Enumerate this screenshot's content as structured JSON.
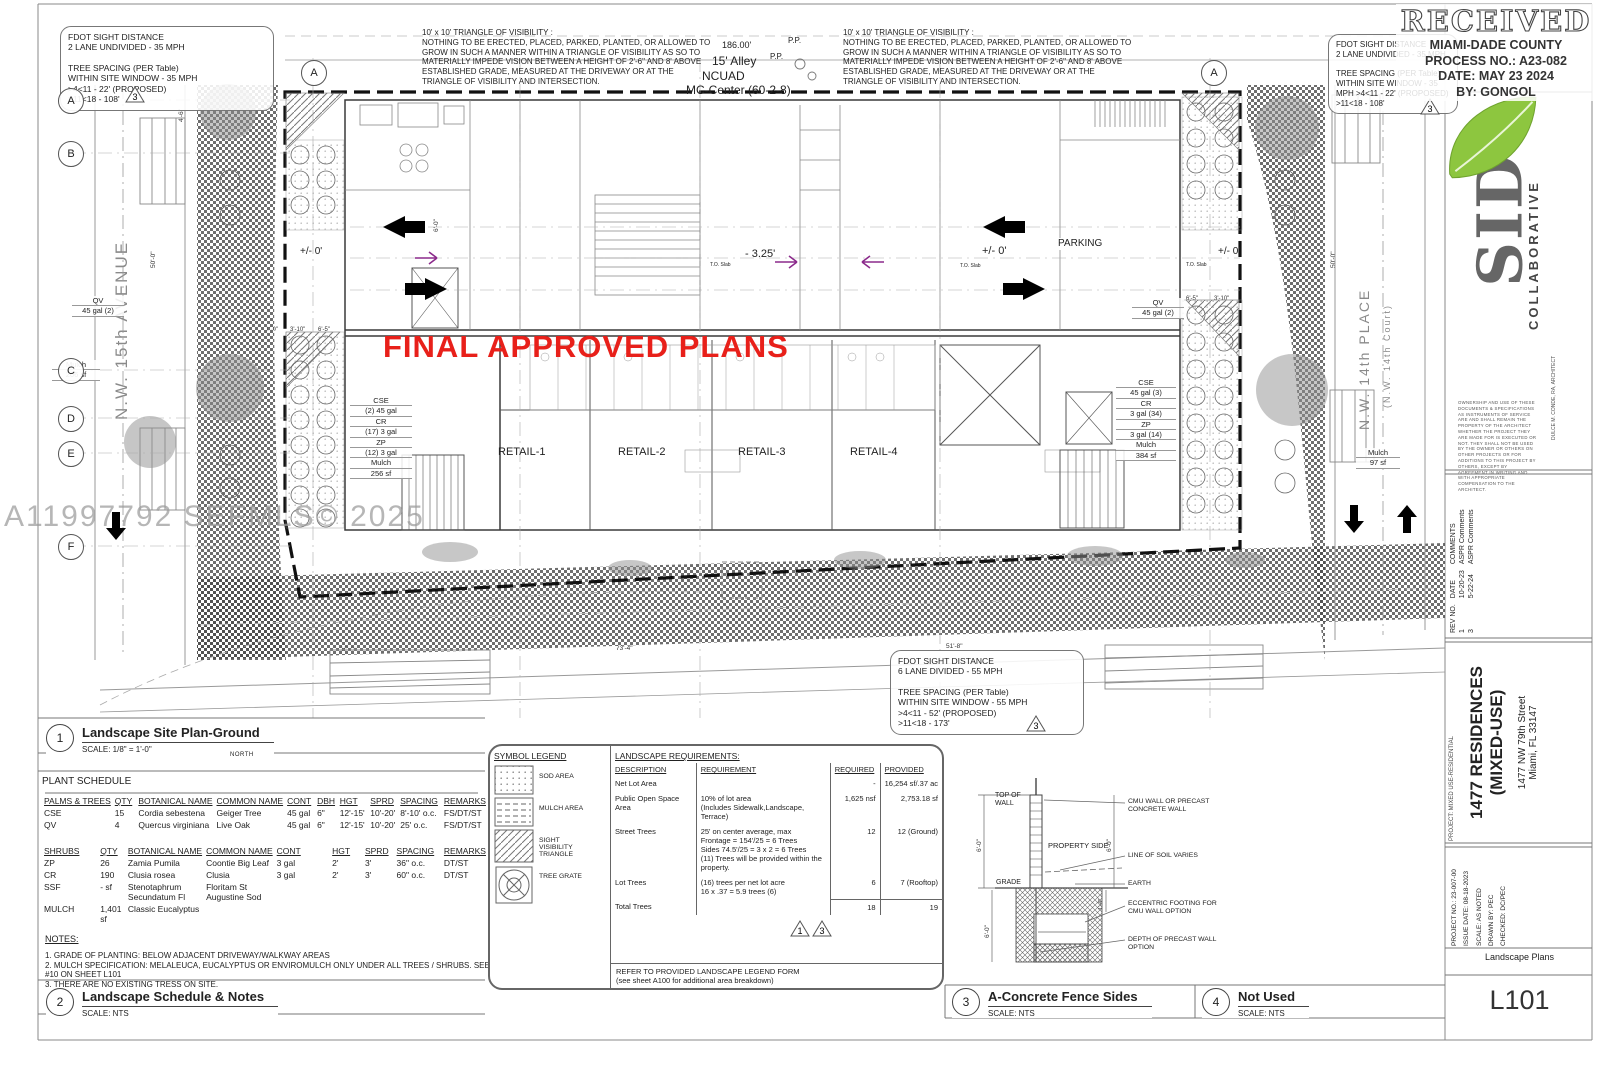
{
  "stamp": {
    "received": "RECEIVED",
    "agency": "MIAMI-DADE COUNTY",
    "process": "PROCESS NO.: A23-082",
    "date": "DATE: MAY 23 2024",
    "by": "BY: GONGOL"
  },
  "plan": {
    "watermark": "A11997792 SEFMLS© 2025",
    "final_approved": "FINAL APPROVED PLANS",
    "visibility_title": "10' x 10' TRIANGLE OF VISIBILITY :",
    "visibility_lines": [
      "NOTHING TO BE ERECTED, PLACED, PARKED, PLANTED, OR ALLOWED TO",
      "GROW IN SUCH A MANNER WITHIN A TRIANGLE OF VISIBILITY AS SO TO",
      "MATERIALLY IMPEDE VISION BETWEEN  A HEIGHT OF 2'-6\" AND 8' ABOVE",
      "ESTABLISHED GRADE, MEASURED AT THE DRIVEWAY OR AT THE",
      "TRIANGLE OF VISIBILITY AND INTERSECTION."
    ],
    "fdot_nw_lines": [
      "FDOT SIGHT DISTANCE",
      "2 LANE UNDIVIDED - 35 MPH",
      "",
      "TREE SPACING (PER Table)",
      "WITHIN SITE WINDOW - 35 MPH",
      ">4<11 - 22' (PROPOSED)",
      ">11<18 - 108'"
    ],
    "fdot_ne_lines": [
      "FDOT SIGHT DISTANCE",
      "2 LANE UNDIVIDED - 35 MPH",
      "",
      "TREE SPACING (PER Table)",
      "WITHIN SITE WINDOW - 35",
      "MPH >4<11 - 22' (PROPOSED)",
      ">11<18 - 108'"
    ],
    "fdot_s_lines": [
      "FDOT SIGHT DISTANCE",
      "6 LANE DIVIDED - 55 MPH",
      "",
      "TREE SPACING (PER Table)",
      "WITHIN SITE WINDOW - 55 MPH",
      ">4<11 - 52' (PROPOSED)",
      ">11<18 - 173'"
    ],
    "alley": {
      "dim": "186.00'",
      "name": "15' Alley",
      "zone1": "NCUAD",
      "zone2": "MC-Center (60-2-8)",
      "pp": "P.P.",
      "pp2": "P.P."
    },
    "streets": {
      "left": "N.W. 15th AVENUE",
      "right": "N.W. 14th PLACE",
      "right_sub": "(N.W. 14th Court)"
    },
    "retail": [
      "RETAIL-1",
      "RETAIL-2",
      "RETAIL-3",
      "RETAIL-4"
    ],
    "parking": "PARKING",
    "elev": {
      "left": "+/- 0'",
      "mid_neg": "- 3.25'",
      "mid_pos": "+/- 0'",
      "right": "+/- 0'",
      "to_slab": "T.O. Slab"
    },
    "planting_left": [
      "QV",
      "45 gal (2)"
    ],
    "mulch_left": [
      "Mulch",
      "206 sf"
    ],
    "stack_left": [
      "CSE",
      "(2) 45 gal",
      "CR",
      "(17) 3 gal",
      "ZP",
      "(12) 3 gal",
      "Mulch",
      "256 sf"
    ],
    "planting_right": [
      "QV",
      "45 gal (2)"
    ],
    "stack_right": [
      "CSE",
      "45 gal (3)",
      "CR",
      "3 gal (34)",
      "ZP",
      "3 gal (14)",
      "Mulch",
      "384 sf"
    ],
    "mulch_right": [
      "Mulch",
      "97 sf"
    ],
    "grid_bubbles_left": [
      "A",
      "B",
      "C",
      "D",
      "E",
      "F"
    ],
    "grid_bubble_top_left": "A",
    "grid_bubble_top_right": "A",
    "tri1": "1",
    "tri3": "3",
    "dims": {
      "d50": "50'-0\"",
      "d50b": "50'-0\"",
      "d25": "25'-0\"",
      "d73": "73'-4\"",
      "d51": "51'-8\"",
      "d65": "6'-5\"",
      "d310": "3'-10\"",
      "d46": "4'-6\"",
      "d10": "1'-0\"",
      "d60": "6'-0\""
    }
  },
  "drawings": {
    "d1": {
      "num": "1",
      "title": "Landscape Site Plan-Ground",
      "scale": "SCALE: 1/8\" = 1'-0\"",
      "north": "NORTH"
    },
    "d2": {
      "num": "2",
      "title": "Landscape Schedule & Notes",
      "scale": "SCALE: NTS"
    },
    "d3": {
      "num": "3",
      "title": "A-Concrete Fence Sides",
      "scale": "SCALE: NTS"
    },
    "d4": {
      "num": "4",
      "title": "Not Used",
      "scale": "SCALE: NTS"
    }
  },
  "plant_schedule": {
    "title": "PLANT SCHEDULE",
    "trees_headers": [
      "PALMS & TREES",
      "QTY",
      "BOTANICAL NAME",
      "COMMON NAME",
      "CONT",
      "DBH",
      "HGT",
      "SPRD",
      "SPACING",
      "REMARKS"
    ],
    "trees_rows": [
      [
        "CSE",
        "15",
        "Cordia sebestena",
        "Geiger Tree",
        "45 gal",
        "6\"",
        "12'-15'",
        "10'-20'",
        "8'-10' o.c.",
        "FS/DT/ST"
      ],
      [
        "QV",
        "4",
        "Quercus virginiana",
        "Live Oak",
        "45 gal",
        "6\"",
        "12'-15'",
        "10'-20'",
        "25' o.c.",
        "FS/DT/ST"
      ]
    ],
    "shrubs_headers": [
      "SHRUBS",
      "QTY",
      "BOTANICAL NAME",
      "COMMON NAME",
      "CONT",
      "",
      "HGT",
      "SPRD",
      "SPACING",
      "REMARKS"
    ],
    "shrubs_rows": [
      [
        "ZP",
        "26",
        "Zamia Pumila",
        "Coontie Big Leaf",
        "3 gal",
        "",
        "2'",
        "3'",
        "36\" o.c.",
        "DT/ST"
      ],
      [
        "CR",
        "190",
        "Clusia rosea",
        "Clusia",
        "3 gal",
        "",
        "2'",
        "3'",
        "60\" o.c.",
        "DT/ST"
      ],
      [
        "SSF",
        "- sf",
        "Stenotaphrum Secundatum Fl",
        "Floritam St Augustine Sod",
        "",
        "",
        "",
        "",
        "",
        ""
      ],
      [
        "MULCH",
        "1,401 sf",
        "Classic Eucalyptus",
        "",
        "",
        "",
        "",
        "",
        "",
        ""
      ]
    ]
  },
  "notes": {
    "title": "NOTES:",
    "lines": [
      "1.  GRADE OF PLANTING:        BELOW ADJACENT DRIVEWAY/WALKWAY AREAS",
      "2.  MULCH SPECIFICATION:    MELALEUCA, EUCALYPTUS OR ENVIROMULCH ONLY UNDER ALL TREES / SHRUBS. SEE NOTE",
      "#10 ON SHEET L101",
      "3.  THERE ARE NO EXISTING TRESS ON SITE."
    ]
  },
  "symbol_legend": {
    "title": "SYMBOL LEGEND",
    "items": [
      "SOD AREA",
      "MULCH AREA",
      "SIGHT VISIBILITY\nTRIANGLE",
      "TREE GRATE"
    ]
  },
  "requirements": {
    "title": "LANDSCAPE REQUIREMENTS:",
    "headers": [
      "DESCRIPTION",
      "REQUIREMENT",
      "REQUIRED",
      "PROVIDED"
    ],
    "rows": [
      [
        "Net Lot Area",
        "",
        "-",
        "16,254 sf/.37 ac"
      ],
      [
        "Public Open Space Area",
        "10% of lot area\n(Includes Sidewalk,Landscape,\n Terrace)",
        "1,625 nsf",
        "2,753.18 sf"
      ],
      [
        "Street Trees",
        "25' on center average, max\nFrontage  = 154'/25 = 6 Trees\nSides 74.5'/25 = 3 x 2 = 6 Trees\n(11) Trees will be provided within the\nproperty.",
        "12",
        "12 (Ground)"
      ],
      [
        "Lot Trees",
        "(16) trees per net lot acre\n16 x .37 = 5.9 trees (6)",
        "6",
        "7 (Rooftop)"
      ],
      [
        "Total Trees",
        "",
        "18",
        "19"
      ]
    ],
    "footer_lines": [
      "REFER TO PROVIDED LANDSCAPE LEGEND FORM",
      "(see sheet A100 for additional area breakdown)"
    ]
  },
  "fence": {
    "top_of_wall": "TOP OF\nWALL",
    "property_side": "PROPERTY SIDE",
    "grade": "GRADE",
    "cmu": "CMU WALL OR PRECAST\nCONCRETE WALL",
    "soil": "LINE OF SOIL VARIES",
    "earth": "EARTH",
    "eccentric": "ECCENTRIC FOOTING FOR\nCMU WALL OPTION",
    "depth": "DEPTH OF PRECAST WALL\nOPTION",
    "dim_a": "6'-0\"",
    "dim_b": "6'-0\"",
    "dim_c": "6'-0\"",
    "dim_d": "4'-0\"",
    "dim_e": "1'-4\""
  },
  "titleblock": {
    "logo_letters": "SID",
    "logo_vertical": "COLLABORATIVE",
    "architect": "DULCE M. CONDE, RA, ARCHITECT",
    "disclaimer": "OWNERSHIP AND USE OF THESE DOCUMENTS & SPECIFICATIONS AS INSTRUMENTS OF SERVICE ARE AND SHALL REMAIN THE PROPERTY OF THE ARCHITECT WHETHER THE PROJECT THEY ARE MADE FOR IS EXECUTED OR NOT. THEY SHALL NOT BE USED BY THE OWNER OR OTHERS ON OTHER PROJECTS OR FOR ADDITIONS TO THIS PROJECT BY OTHERS, EXCEPT BY AGREEMENT IN WRITING AND WITH APPROPRIATE COMPENSATION TO THE ARCHITECT.",
    "revisions": {
      "headers": [
        "REV NO.",
        "DATE",
        "COMMENTS"
      ],
      "rows": [
        [
          "1",
          "10-20-23",
          "ASPR Comments"
        ],
        [
          "3",
          "5-22-24",
          "ASPR Comments"
        ]
      ]
    },
    "project_type": "PROJECT: MIXED USE-RESIDENTIAL",
    "project_name1": "1477 RESIDENCES",
    "project_name2": "(MIXED-USE)",
    "address1": "1477 NW 79th Street",
    "address2": "Miami, FL 33147",
    "info_lines": [
      "PROJECT NO.:   23-007-00",
      "ISSUE DATE:   08-18-2023",
      "SCALE:   AS NOTED",
      "DRAWN BY:   PEC",
      "CHECKED:   DC/PEC"
    ],
    "sheet_name": "Landscape Plans",
    "sheet_no": "L101"
  },
  "colors": {
    "approved_red": "#e8201a",
    "leaf_green": "#8dc63f",
    "line": "#444"
  }
}
